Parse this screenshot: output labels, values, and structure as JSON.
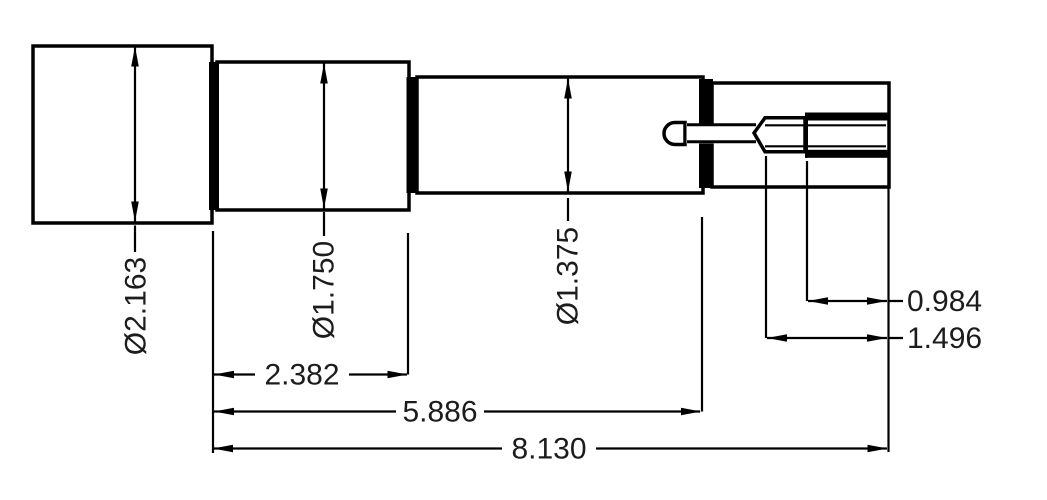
{
  "drawing": {
    "view": "stepped-shaft-side-view",
    "colors": {
      "line": "#000000",
      "background": "#ffffff"
    }
  },
  "dimensions": {
    "diameter_section1": "Ø2.163",
    "diameter_section2": "Ø1.750",
    "diameter_section3": "Ø1.375",
    "section2_length": "2.382",
    "shoulder_length": "5.886",
    "overall_length": "8.130",
    "thread_length": "0.984",
    "stud_length": "1.496"
  }
}
